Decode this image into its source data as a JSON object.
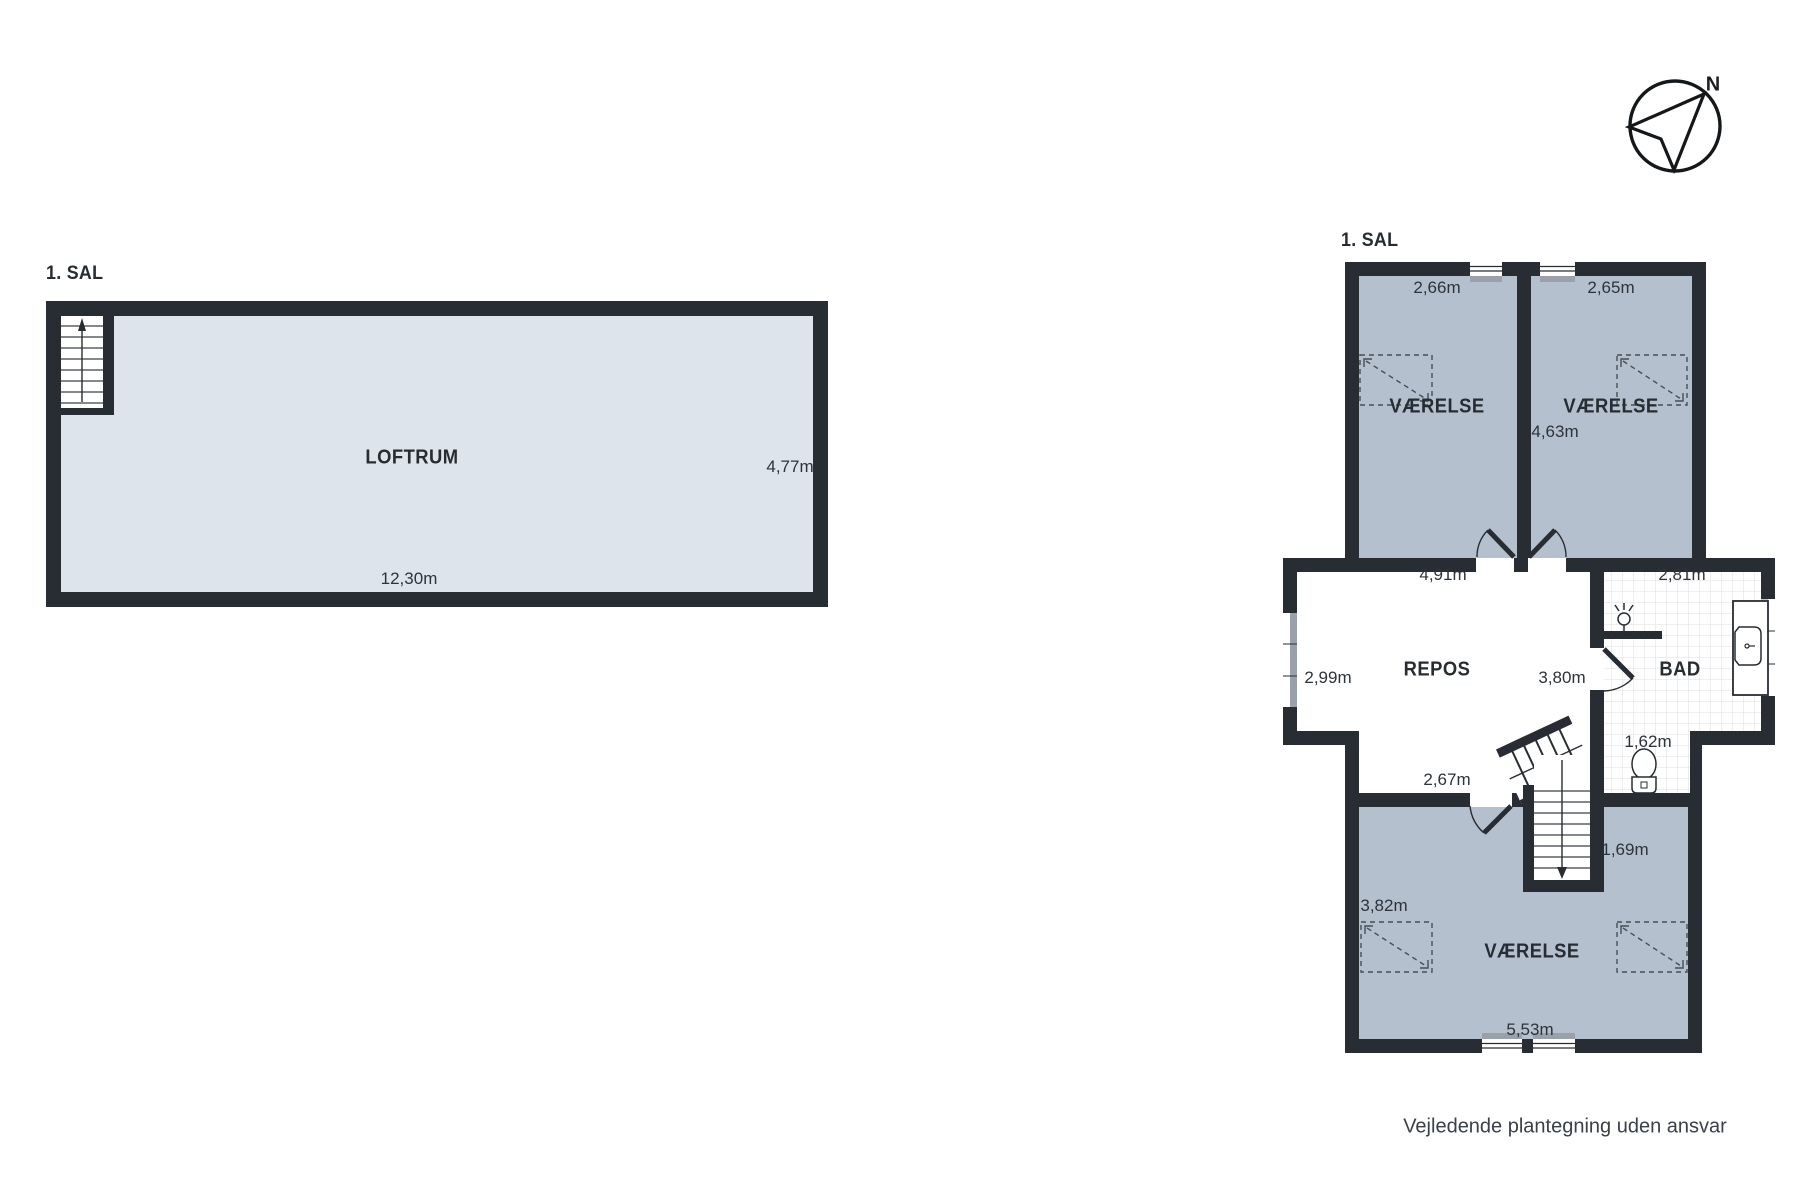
{
  "page": {
    "footer": "Vejledende plantegning uden ansvar"
  },
  "compass": {
    "label": "N"
  },
  "colors": {
    "wall": "#272d33",
    "room_fill": "#b5c0cf",
    "loft_fill": "#dde4ec",
    "sill": "#9aa1ab",
    "tile_line": "#dcdee1"
  },
  "left_plan": {
    "floor_label": "1. SAL",
    "loftrum": {
      "name": "LOFTRUM",
      "width": "12,30m",
      "depth": "4,77m"
    }
  },
  "right_plan": {
    "floor_label": "1. SAL",
    "bedroom_top_left": {
      "name": "VÆRELSE",
      "width": "2,66m"
    },
    "bedroom_top_right": {
      "name": "VÆRELSE",
      "width": "2,65m",
      "depth": "4,63m"
    },
    "landing": {
      "name": "REPOS",
      "width_top": "4,91m",
      "depth_left": "2,99m",
      "depth_right": "3,80m",
      "width_bottom": "2,67m"
    },
    "bathroom": {
      "name": "BAD",
      "width": "2,81m",
      "toilet_width": "1,62m"
    },
    "stairs": {
      "width": "1,69m"
    },
    "bedroom_bottom": {
      "name": "VÆRELSE",
      "left_width": "3,82m",
      "width": "5,53m"
    }
  }
}
